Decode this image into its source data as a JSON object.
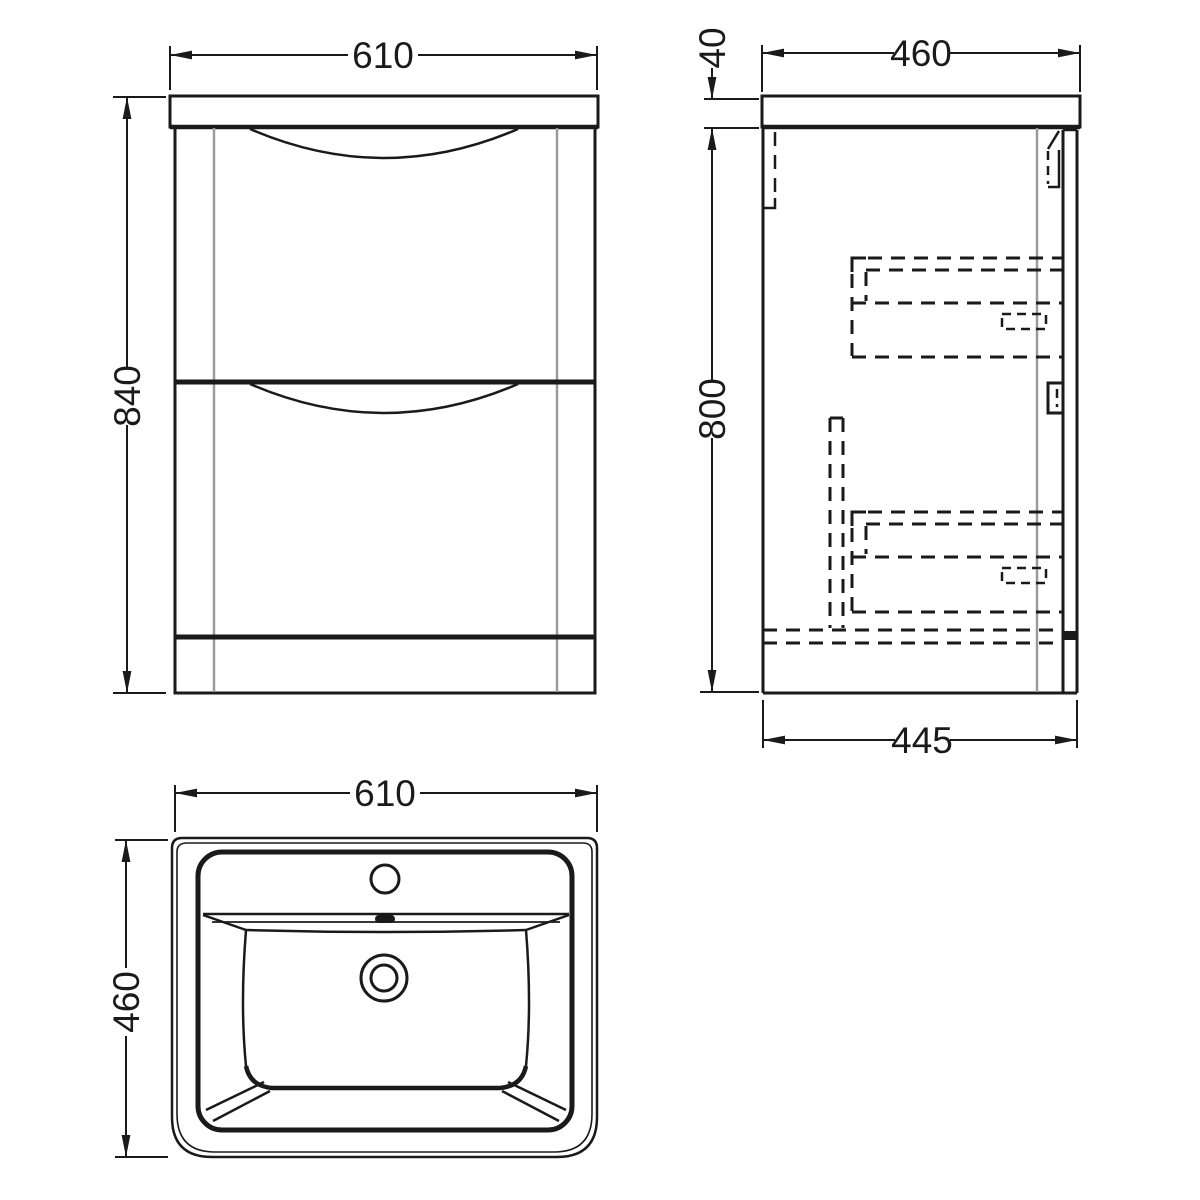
{
  "drawing": {
    "front_view": {
      "width_mm": "610",
      "height_mm": "840"
    },
    "side_view": {
      "worktop_thickness_mm": "40",
      "top_depth_mm": "460",
      "body_height_mm": "800",
      "bottom_depth_mm": "445"
    },
    "plan_view": {
      "width_mm": "610",
      "depth_mm": "460"
    }
  },
  "colors": {
    "line": "#1a1a1a",
    "panel_edge": "#9b9b9b",
    "background": "#ffffff"
  }
}
